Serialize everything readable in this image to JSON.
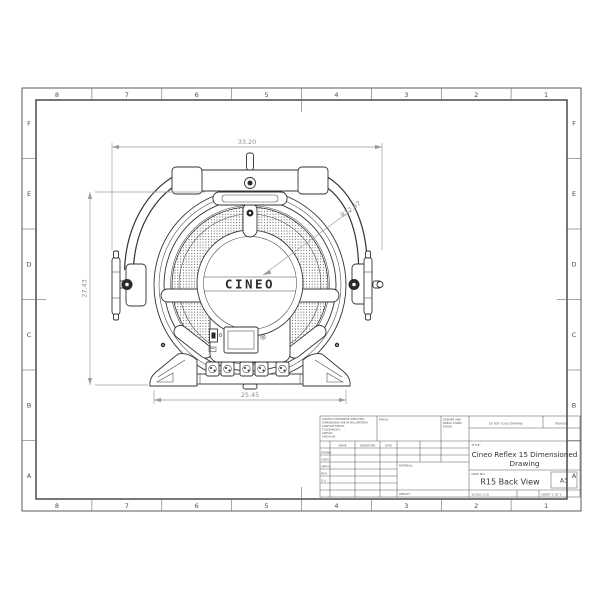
{
  "drawing": {
    "dim_width_top": "33.20",
    "dim_height_left": "27.43",
    "dim_width_bottom": "25.45",
    "dim_radius": "R12.47",
    "logo": "CINEO"
  },
  "sheet": {
    "zone_columns": [
      "8",
      "7",
      "6",
      "5",
      "4",
      "3",
      "2",
      "1"
    ],
    "zone_rows": [
      "F",
      "E",
      "D",
      "C",
      "B",
      "A"
    ]
  },
  "title_block": {
    "tolerance_notes": [
      "UNLESS OTHERWISE SPECIFIED:",
      "DIMENSIONS ARE IN MILLIMETERS",
      "SURFACE FINISH:",
      "TOLERANCES:",
      "   LINEAR:",
      "   ANGULAR:"
    ],
    "finish_label": "FINISH:",
    "deburr_lines": [
      "DEBURR AND",
      "BREAK SHARP",
      "EDGES"
    ],
    "do_not_scale": "DO NOT SCALE DRAWING",
    "revision_label": "REVISION",
    "col_name": "NAME",
    "col_signature": "SIGNATURE",
    "col_date": "DATE",
    "approval_rows": [
      "DRAWN",
      "CHK'D",
      "APPV'D",
      "MFG",
      "Q.A"
    ],
    "material_label": "MATERIAL:",
    "weight_label": "WEIGHT:",
    "title_label": "TITLE:",
    "title_line1": "Cineo Reflex 15 Dimensioned",
    "title_line2": "Drawing",
    "dwg_label": "DWG NO.",
    "dwg_no": "R15 Back View",
    "paper_size": "A3",
    "scale_label": "SCALE:1:10",
    "sheet_label": "SHEET 1 OF 1"
  }
}
